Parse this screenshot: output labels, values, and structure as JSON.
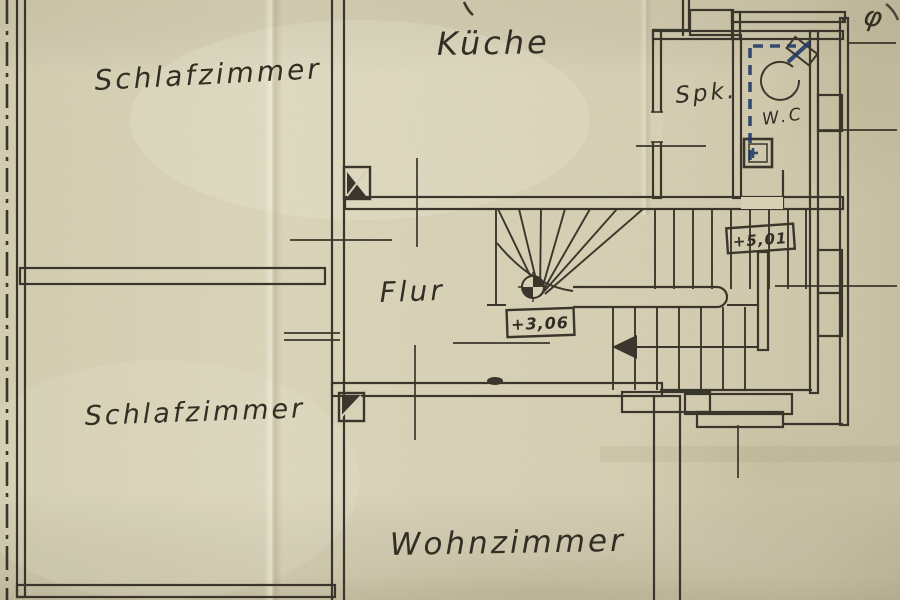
{
  "plan": {
    "room_labels": {
      "schlafzimmer_top": "Schlafzimmer",
      "kueche": "Küche",
      "spk": "Spk.",
      "wc": "W.C",
      "flur": "Flur",
      "schlafzimmer_bottom": "Schlafzimmer",
      "wohnzimmer": "Wohnzimmer"
    },
    "level_markers": {
      "flur_level": "+3,06",
      "stair_level": "+5,01"
    },
    "handwritten_note": "φ",
    "colors": {
      "ink": "#3b362b",
      "blue_ink": "#1f3a66",
      "paper": "#d7d0b5"
    }
  }
}
